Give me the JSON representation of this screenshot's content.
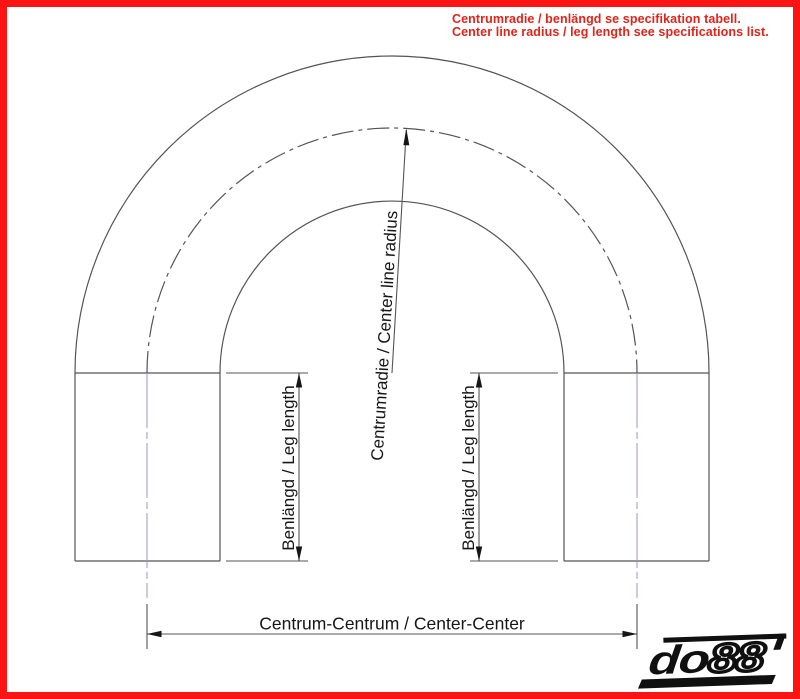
{
  "frame": {
    "border_color": "#fa1414",
    "background": "#ffffff"
  },
  "notice": {
    "line1": "Centrumradie / benlängd se specifikation tabell.",
    "line2": "Center line radius / leg length see specifications list.",
    "color": "#e2231a"
  },
  "diagram": {
    "labels": {
      "radius": "Centrumradie / Center line radius",
      "leg_length": "Benlängd / Leg length",
      "center_center": "Centrum-Centrum / Center-Center"
    },
    "colors": {
      "outline": "#545454",
      "centerline_legs": "#a98fc2",
      "dimension_text": "#161616",
      "arrowheads": "#161616"
    }
  },
  "logo": {
    "prefix": "do",
    "digits": "88"
  }
}
